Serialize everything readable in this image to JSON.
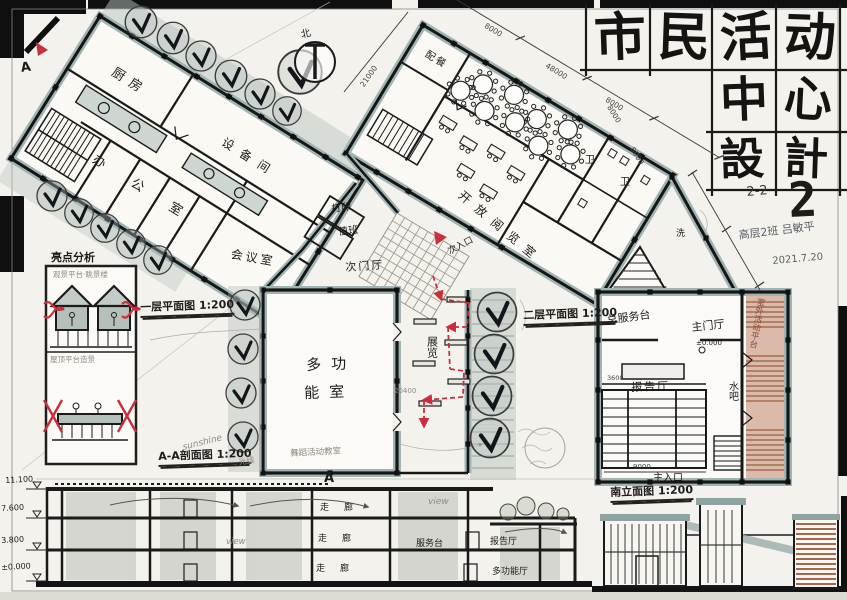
{
  "colors": {
    "paper": "#f4f2ec",
    "ink": "#1c1c1c",
    "poche_teal": "#9fb5b4",
    "wash_green": "#b7c3bc",
    "deck_terracotta": "#b5795c",
    "accent_red": "#c9303c",
    "pencil": "#8f8b83"
  },
  "title_block": {
    "chars_row1": [
      "市",
      "民",
      "活",
      "动"
    ],
    "chars_row2": [
      "中",
      "心"
    ],
    "chars_row3": [
      "設",
      "計"
    ],
    "code": "2-2",
    "sheet_number": "2",
    "author_line": "高层2班 吕敏平",
    "date": "2021.7.20"
  },
  "marks": {
    "north": "北",
    "section_letter": "A"
  },
  "rooms": {
    "kitchen": "厨房",
    "equipment": "设备间",
    "offices": "办公室",
    "meeting": "会议室",
    "pantry": "配餐",
    "print": "打印",
    "duty": "值班",
    "sub_hall": "次门厅",
    "open_reading": "开放阅览室",
    "wc_a": "卫",
    "wc_b": "卫",
    "wash": "洗",
    "multi_line1": "多功",
    "multi_line2": "能室",
    "exhibition": "展览",
    "service_desk": "总服务台",
    "main_hall": "主门厅",
    "lecture_hall": "报告厅",
    "water_bar": "水吧",
    "deck": "室外活动平台"
  },
  "entrances": {
    "main": "主入口",
    "secondary": "次入口"
  },
  "titles": {
    "floor_plan": "一层平面图 1:200",
    "second_floor": "二层平面图 1:200",
    "section": "A-A剖面图 1:200",
    "elevation": "南立面图 1:200",
    "analysis": "亮点分析"
  },
  "notes": {
    "caption_top": "观景平台·眺景楼",
    "caption_bottom": "屋顶平台造景",
    "sunshine": "sunshine",
    "light": "光线",
    "view": "view",
    "dance": "舞蹈活动教室"
  },
  "section": {
    "corridors": [
      "走廊",
      "走廊",
      "走廊"
    ],
    "service": "服务台",
    "lecture": "报告厅",
    "multi": "多功能厅",
    "levels": [
      "11.100",
      "7.600",
      "3.800",
      "±0.000"
    ],
    "hall_level": "±0.000"
  },
  "dims": {
    "top_a": "8000",
    "total": "48000",
    "top_b": "8000",
    "facade_a": "8000",
    "facade_b": "8000",
    "left": "21000",
    "note": "20400",
    "bottom": "9000",
    "seat": "3600"
  }
}
